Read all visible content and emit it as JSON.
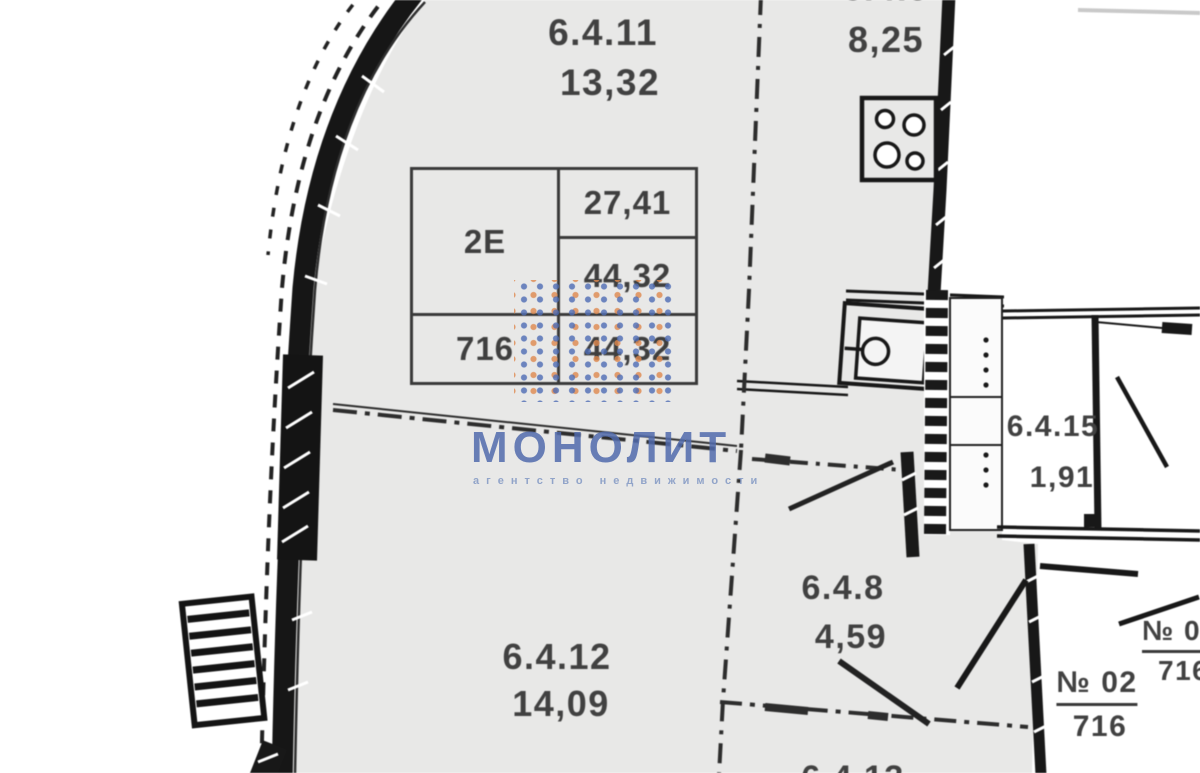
{
  "plan": {
    "rooms": {
      "r6411": {
        "id": "6.4.11",
        "area": "13,32"
      },
      "kitchen": {
        "id": "6.4.9",
        "area": "8,25"
      },
      "r6412": {
        "id": "6.4.12",
        "area": "14,09"
      },
      "r648": {
        "id": "6.4.8",
        "area": "4,59"
      },
      "r6415": {
        "id": "6.4.15",
        "area": "1,91"
      },
      "r6413": {
        "id": "6.4.13"
      }
    },
    "summary_table": {
      "unit_type": "2Е",
      "area_top": "27,41",
      "area_mid": "44,32",
      "unit_number": "716",
      "area_bottom": "44,32"
    },
    "apartments": {
      "apt02": {
        "label": "№ 02",
        "number": "716"
      },
      "apt_partial": {
        "label": "№ 02",
        "number": "716"
      }
    }
  },
  "watermark": {
    "brand": "МОНОЛИТ",
    "tagline": "агентство недвижимости",
    "colors": {
      "brand": "#506ab0",
      "dot_blue": "#4e6cb4",
      "dot_orange": "#df884d"
    }
  }
}
